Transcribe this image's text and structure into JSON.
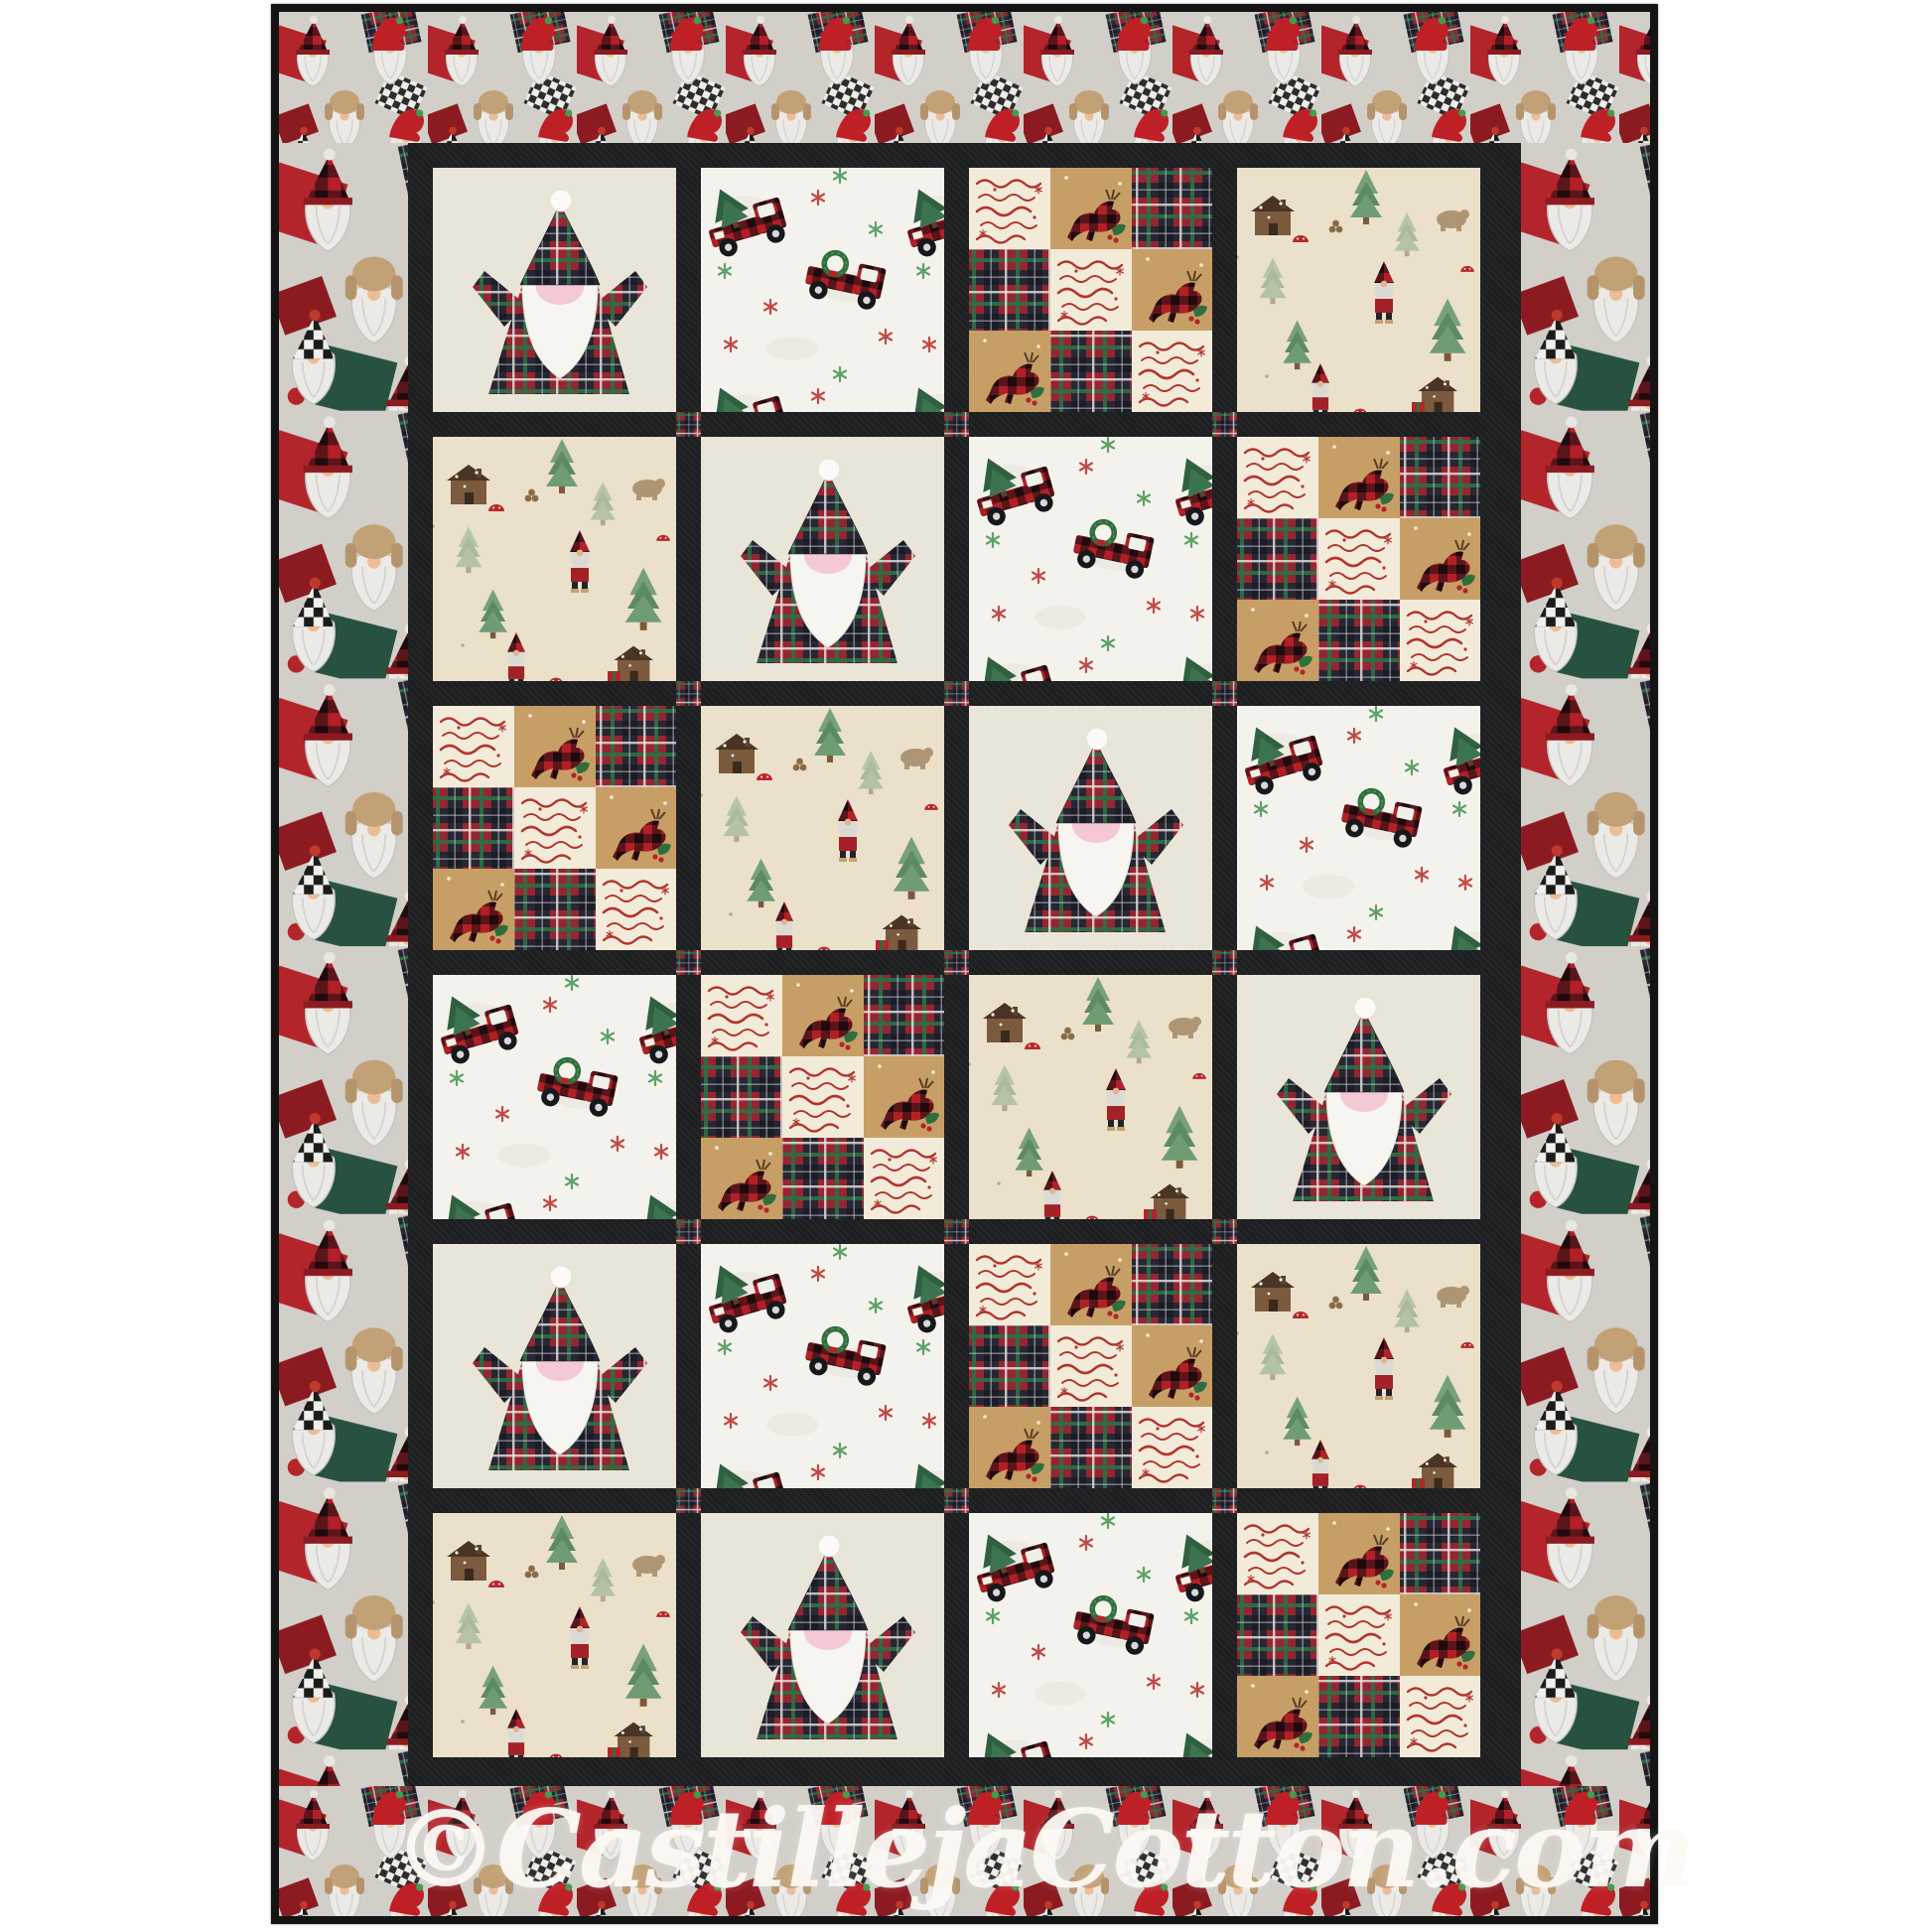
{
  "image_type": "Product photo of a finished Christmas gnome quilt",
  "watermark": {
    "text": "©CastillejaCotton.com"
  },
  "quilt": {
    "rows": 6,
    "cols": 4,
    "block_sequence": [
      [
        "gnome-applique",
        "trucks",
        "patchwork",
        "gnome-scene"
      ],
      [
        "gnome-scene",
        "gnome-applique",
        "trucks",
        "patchwork"
      ],
      [
        "patchwork",
        "gnome-scene",
        "gnome-applique",
        "trucks"
      ],
      [
        "trucks",
        "patchwork",
        "gnome-scene",
        "gnome-applique"
      ],
      [
        "gnome-applique",
        "trucks",
        "patchwork",
        "gnome-scene"
      ],
      [
        "gnome-scene",
        "gnome-applique",
        "trucks",
        "patchwork"
      ]
    ],
    "block_types": {
      "gnome-applique": "Appliqued plaid gnome with white beard on cream background",
      "trucks": "Red buffalo-plaid trucks carrying Christmas trees on white",
      "patchwork": "Patchwork of tartan, holiday-words and plaid reindeer squares",
      "gnome-scene": "Woodland Santa gnomes, log cabins, pines, bears and mushrooms"
    },
    "border_fabric": "Crowded Christmas gnomes print (red, plaid and fur hats, grey beards)",
    "sashing": "black with red plaid cornerstones",
    "colors": {
      "page_background": "#ffffff",
      "binding_black": "#141414",
      "sashing_black": "#1d1e20",
      "block_cream": "#e9e5d8",
      "tartan_red": "#962531",
      "tartan_green": "#2f6b44",
      "tartan_dark": "#262732",
      "buffalo_red": "#b22026",
      "beard_white": "#f7f5f0",
      "nose_pink": "#f4c9d5",
      "scene_tan": "#ebe1cb",
      "truck_white": "#f4f2ec",
      "patch_tan": "#c79f66",
      "script_red": "#b23530",
      "border_grey": "#d2cfc9"
    }
  }
}
